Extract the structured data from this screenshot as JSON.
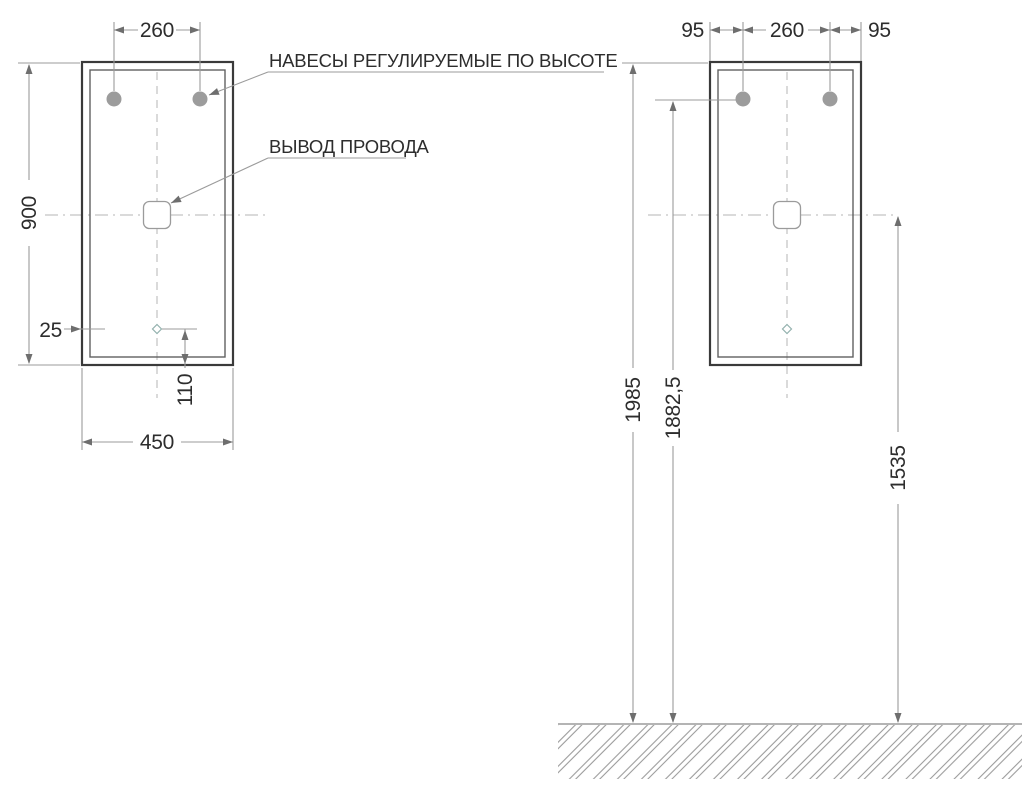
{
  "labels": {
    "hangers_note": "НАВЕСЫ РЕГУЛИРУЕМЫЕ ПО ВЫСОТЕ",
    "wire_note": "ВЫВОД ПРОВОДА"
  },
  "front_view": {
    "dims": {
      "hanger_spacing": "260",
      "height": "900",
      "side_inset": "25",
      "outlet_bottom_offset": "110",
      "width": "450"
    }
  },
  "install_view": {
    "dims": {
      "left_offset": "95",
      "hanger_spacing": "260",
      "right_offset": "95",
      "top_height": "1985",
      "hanger_height": "1882,5",
      "outlet_height": "1535"
    }
  },
  "colors": {
    "outline": "#3a3a3a",
    "inner_line": "#606060",
    "dim_line": "#9b9b9b",
    "centerline": "#b4b4b4",
    "arrow": "#6e6e6e",
    "hanger_fill": "#9c9c9c",
    "text": "#2d2d2d",
    "hatch": "#9b9b9b",
    "marker": "#93b1ae",
    "background": "#ffffff"
  }
}
